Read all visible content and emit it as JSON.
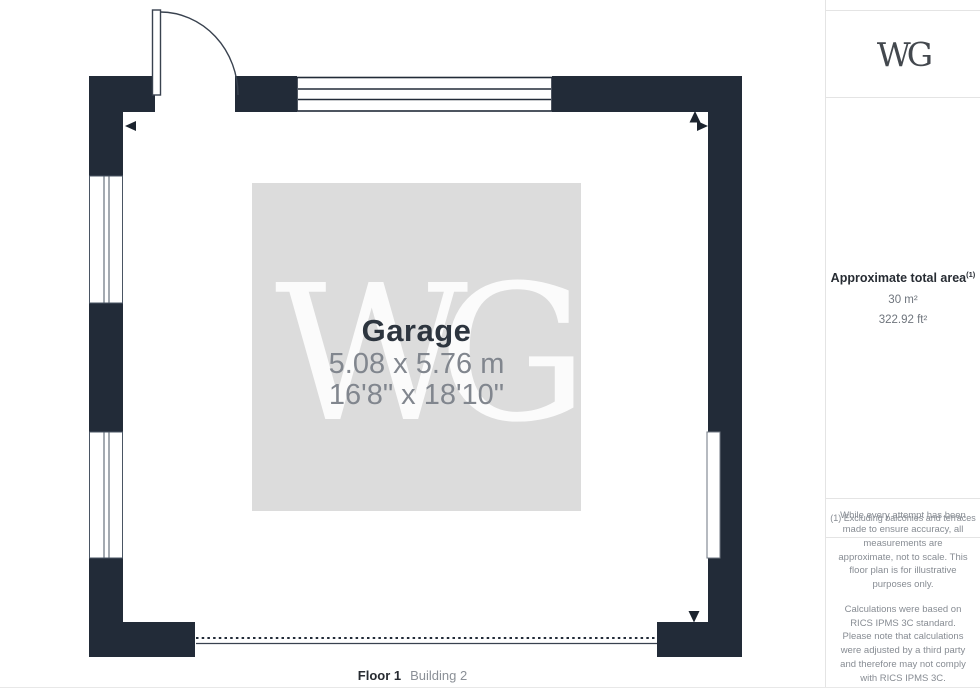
{
  "floor_plan": {
    "room": {
      "name": "Garage",
      "dimensions_metric": "5.08 x 5.76 m",
      "dimensions_imperial": "16'8\" x 18'10\""
    },
    "watermark": "WG",
    "floor_label": {
      "floor": "Floor 1",
      "building": "Building 2"
    },
    "colors": {
      "wall": "#222B38",
      "room_fill": "#DCDCDC",
      "room_name_text": "#2D353F",
      "dimension_text": "#81868E"
    }
  },
  "sidebar": {
    "logo": "WG",
    "area": {
      "title": "Approximate total area",
      "title_sup": "(1)",
      "metric": "30 m²",
      "imperial": "322.92 ft²"
    },
    "footnote": "(1) Excluding balconies and terraces",
    "disclaimer_1": "While every attempt has been made to ensure accuracy, all measurements are approximate, not to scale. This floor plan is for illustrative purposes only.",
    "disclaimer_2": "Calculations were based on RICS IPMS 3C standard. Please note that calculations were adjusted by a third party and therefore may not comply with RICS IPMS 3C.",
    "brand": {
      "name": "GIRAFFE",
      "suffix": "360"
    }
  }
}
